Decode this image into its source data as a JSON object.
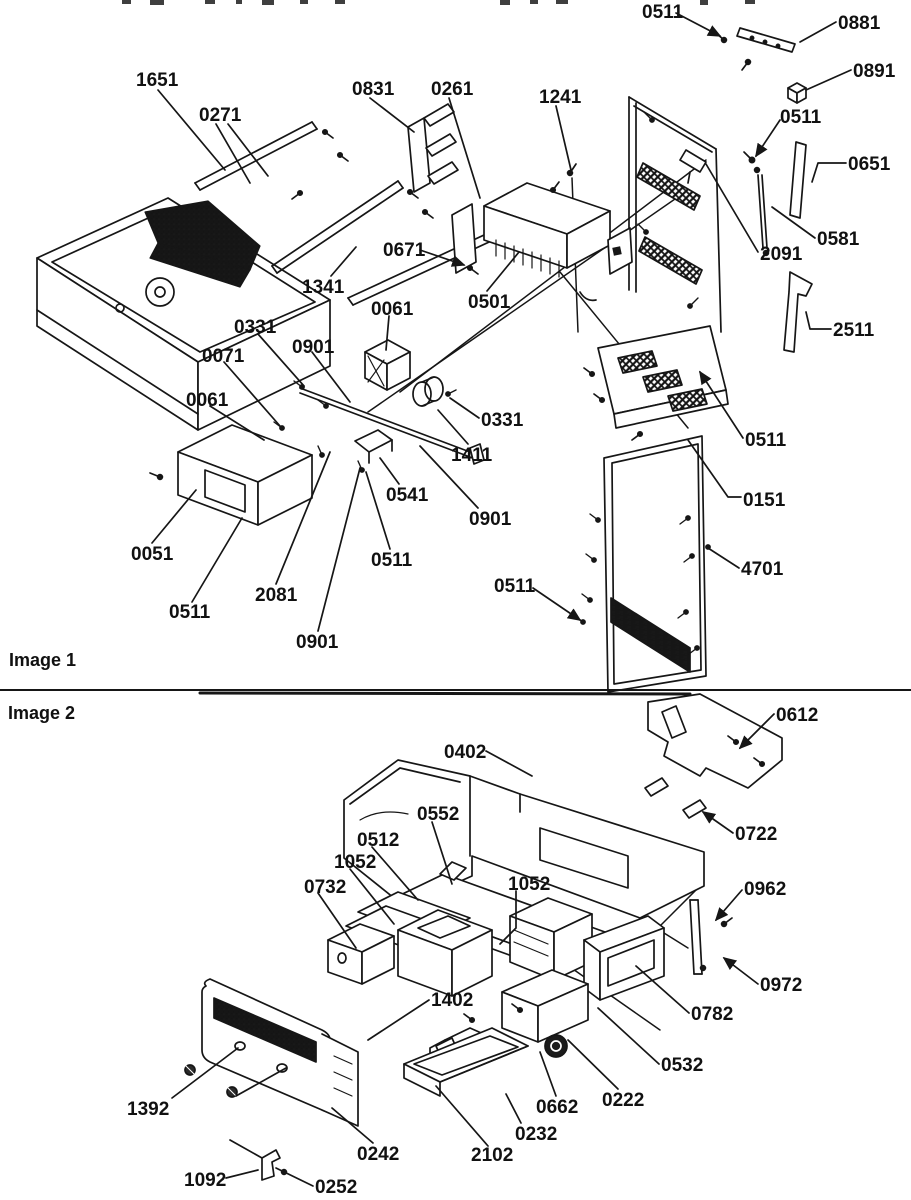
{
  "page": {
    "background": "#ffffff",
    "ink": "#161616"
  },
  "image1": {
    "caption": "Image 1",
    "labels": [
      {
        "text": "0511",
        "x": 642,
        "y": 3
      },
      {
        "text": "0881",
        "x": 838,
        "y": 14
      },
      {
        "text": "0891",
        "x": 853,
        "y": 62
      },
      {
        "text": "1651",
        "x": 136,
        "y": 71
      },
      {
        "text": "0271",
        "x": 199,
        "y": 106
      },
      {
        "text": "0831",
        "x": 352,
        "y": 80
      },
      {
        "text": "0261",
        "x": 431,
        "y": 80
      },
      {
        "text": "1241",
        "x": 539,
        "y": 88
      },
      {
        "text": "0511",
        "x": 780,
        "y": 108
      },
      {
        "text": "0651",
        "x": 848,
        "y": 155
      },
      {
        "text": "0581",
        "x": 817,
        "y": 230
      },
      {
        "text": "2091",
        "x": 760,
        "y": 245
      },
      {
        "text": "0671",
        "x": 383,
        "y": 241
      },
      {
        "text": "1341",
        "x": 302,
        "y": 278
      },
      {
        "text": "0501",
        "x": 468,
        "y": 293
      },
      {
        "text": "2511",
        "x": 833,
        "y": 321
      },
      {
        "text": "0061",
        "x": 371,
        "y": 300
      },
      {
        "text": "0331",
        "x": 234,
        "y": 318
      },
      {
        "text": "0901",
        "x": 292,
        "y": 338
      },
      {
        "text": "0071",
        "x": 202,
        "y": 347
      },
      {
        "text": "0061",
        "x": 186,
        "y": 391
      },
      {
        "text": "0331",
        "x": 481,
        "y": 411
      },
      {
        "text": "1411",
        "x": 451,
        "y": 446
      },
      {
        "text": "0511",
        "x": 745,
        "y": 431
      },
      {
        "text": "0541",
        "x": 386,
        "y": 486
      },
      {
        "text": "0151",
        "x": 743,
        "y": 491
      },
      {
        "text": "0901",
        "x": 469,
        "y": 510
      },
      {
        "text": "0051",
        "x": 131,
        "y": 545
      },
      {
        "text": "0511",
        "x": 371,
        "y": 551
      },
      {
        "text": "2081",
        "x": 255,
        "y": 586
      },
      {
        "text": "0511",
        "x": 494,
        "y": 577
      },
      {
        "text": "4701",
        "x": 741,
        "y": 560
      },
      {
        "text": "0511",
        "x": 169,
        "y": 603
      },
      {
        "text": "0901",
        "x": 296,
        "y": 633
      }
    ]
  },
  "image2": {
    "caption": "Image 2",
    "labels": [
      {
        "text": "0612",
        "x": 776,
        "y": 706
      },
      {
        "text": "0402",
        "x": 444,
        "y": 743
      },
      {
        "text": "0552",
        "x": 417,
        "y": 805
      },
      {
        "text": "0512",
        "x": 357,
        "y": 831
      },
      {
        "text": "1052",
        "x": 334,
        "y": 853
      },
      {
        "text": "0732",
        "x": 304,
        "y": 878
      },
      {
        "text": "1052",
        "x": 508,
        "y": 875
      },
      {
        "text": "0722",
        "x": 735,
        "y": 825
      },
      {
        "text": "0962",
        "x": 744,
        "y": 880
      },
      {
        "text": "0972",
        "x": 760,
        "y": 976
      },
      {
        "text": "1402",
        "x": 431,
        "y": 991
      },
      {
        "text": "0782",
        "x": 691,
        "y": 1005
      },
      {
        "text": "0532",
        "x": 661,
        "y": 1056
      },
      {
        "text": "0222",
        "x": 602,
        "y": 1091
      },
      {
        "text": "0662",
        "x": 536,
        "y": 1098
      },
      {
        "text": "1392",
        "x": 127,
        "y": 1100
      },
      {
        "text": "0232",
        "x": 515,
        "y": 1125
      },
      {
        "text": "0242",
        "x": 357,
        "y": 1145
      },
      {
        "text": "2102",
        "x": 471,
        "y": 1146
      },
      {
        "text": "1092",
        "x": 184,
        "y": 1171
      },
      {
        "text": "0252",
        "x": 315,
        "y": 1178
      }
    ]
  }
}
